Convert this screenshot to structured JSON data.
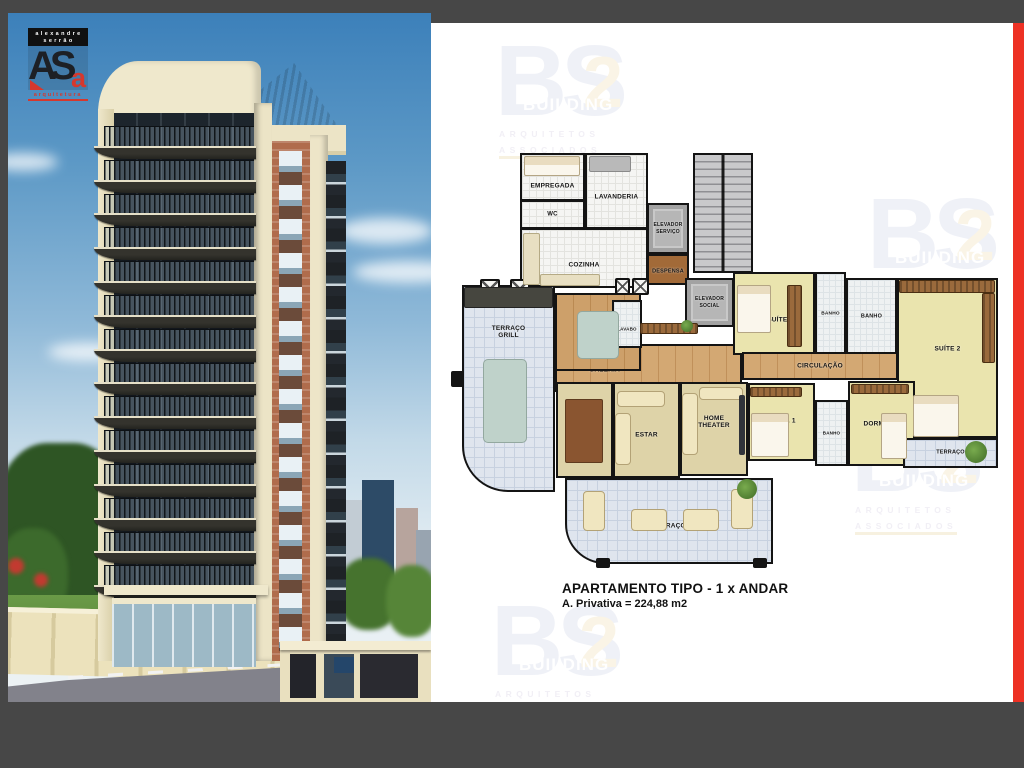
{
  "page": {
    "background": "#474747",
    "accent_red": "#ed3124",
    "panel_bg": "#ffffff"
  },
  "logo": {
    "name_line1": "alexandre",
    "name_line2": "serrão",
    "monogram_main": "AS",
    "monogram_accent": "a",
    "field": "arquitetura"
  },
  "watermark": {
    "letters": "BS",
    "number": "2",
    "word": "BUILDING",
    "sub_line1": "ARQUITETOS",
    "sub_line2": "ASSOCIADOS",
    "positions": [
      {
        "x": 64,
        "y": 10
      },
      {
        "x": 436,
        "y": 163
      },
      {
        "x": 420,
        "y": 386
      },
      {
        "x": 60,
        "y": 570
      }
    ]
  },
  "rendering": {
    "balcony_floors": 14
  },
  "plan": {
    "title": "APARTAMENTO TIPO - 1 x ANDAR",
    "area_note": "A. Privativa = 224,88 m2",
    "rooms": [
      {
        "id": "escada",
        "label": "",
        "x": 262,
        "y": 130,
        "w": 60,
        "h": 120,
        "floor": "stair"
      },
      {
        "id": "cozinha",
        "label": "COZINHA",
        "x": 89,
        "y": 205,
        "w": 128,
        "h": 60,
        "floor": "tile",
        "ty": 62
      },
      {
        "id": "empregada",
        "label": "EMPREGADA",
        "x": 89,
        "y": 130,
        "w": 65,
        "h": 48,
        "floor": "tile",
        "ty": 70
      },
      {
        "id": "wc",
        "label": "WC",
        "x": 89,
        "y": 177,
        "w": 65,
        "h": 29,
        "floor": "tile",
        "fs": 6
      },
      {
        "id": "lavanderia",
        "label": "LAVANDERIA",
        "x": 154,
        "y": 130,
        "w": 63,
        "h": 76,
        "floor": "tile",
        "ty": 58
      },
      {
        "id": "elevador-servico",
        "label": "ELEVADOR\nSERVIÇO",
        "x": 216,
        "y": 180,
        "w": 42,
        "h": 51,
        "floor": "lift",
        "fs": 5
      },
      {
        "id": "despensa",
        "label": "DESPENSA",
        "x": 216,
        "y": 231,
        "w": 42,
        "h": 31,
        "floor": "brown",
        "fs": 5.5,
        "ty": 60
      },
      {
        "id": "elevador-social",
        "label": "ELEVADOR\nSOCIAL",
        "x": 254,
        "y": 255,
        "w": 49,
        "h": 49,
        "floor": "lift",
        "fs": 5
      },
      {
        "id": "terraco-grill",
        "label": "TERRAÇO\nGRILL",
        "x": 31,
        "y": 262,
        "w": 93,
        "h": 207,
        "floor": "terrace",
        "ty": 22,
        "r": "0 0 0 46px"
      },
      {
        "id": "galeria",
        "label": "GALERIA",
        "x": 124,
        "y": 321,
        "w": 187,
        "h": 48,
        "floor": "wood2",
        "tx": 26,
        "ty": 55
      },
      {
        "id": "almoco",
        "label": "ALMOÇO",
        "x": 124,
        "y": 270,
        "w": 86,
        "h": 78,
        "floor": "wood",
        "ty": 58
      },
      {
        "id": "lavabo",
        "label": "LAVABO",
        "x": 181,
        "y": 277,
        "w": 30,
        "h": 48,
        "floor": "bath",
        "fs": 4.5,
        "ty": 62
      },
      {
        "id": "suite1",
        "label": "SUÍTE 1",
        "x": 302,
        "y": 249,
        "w": 82,
        "h": 83,
        "floor": "suite",
        "tx": 58,
        "ty": 58
      },
      {
        "id": "banho-suite1",
        "label": "BANHO",
        "x": 384,
        "y": 249,
        "w": 31,
        "h": 83,
        "floor": "bath",
        "fs": 4.8
      },
      {
        "id": "banho-suite2",
        "label": "BANHO",
        "x": 415,
        "y": 255,
        "w": 51,
        "h": 77,
        "floor": "bath",
        "fs": 5.5
      },
      {
        "id": "suite2",
        "label": "SUÍTE 2",
        "x": 466,
        "y": 255,
        "w": 101,
        "h": 160,
        "floor": "suite",
        "ty": 44
      },
      {
        "id": "circulacao",
        "label": "CIRCULAÇÃO",
        "x": 311,
        "y": 329,
        "w": 156,
        "h": 28,
        "floor": "wood2"
      },
      {
        "id": "jantar",
        "label": "JANTAR",
        "x": 125,
        "y": 359,
        "w": 57,
        "h": 96,
        "floor": "carpet",
        "ty": 46
      },
      {
        "id": "estar",
        "label": "ESTAR",
        "x": 182,
        "y": 359,
        "w": 67,
        "h": 96,
        "floor": "carpet",
        "ty": 55
      },
      {
        "id": "home-theater",
        "label": "HOME\nTHEATER",
        "x": 249,
        "y": 359,
        "w": 68,
        "h": 94,
        "floor": "carpet",
        "ty": 42
      },
      {
        "id": "dorm1",
        "label": "DORM. 1",
        "x": 317,
        "y": 360,
        "w": 67,
        "h": 78,
        "floor": "suite",
        "ty": 48
      },
      {
        "id": "banho-dorms",
        "label": "BANHO",
        "x": 384,
        "y": 377,
        "w": 33,
        "h": 66,
        "floor": "bath",
        "fs": 4.5
      },
      {
        "id": "dorm2",
        "label": "DORM. 2",
        "x": 417,
        "y": 358,
        "w": 67,
        "h": 85,
        "floor": "suite",
        "tx": 44,
        "ty": 50
      },
      {
        "id": "terraco-suite2",
        "label": "TERRAÇO",
        "x": 472,
        "y": 415,
        "w": 95,
        "h": 30,
        "floor": "terrace",
        "fs": 5.5
      },
      {
        "id": "terraco-social",
        "label": "TERRAÇO",
        "x": 134,
        "y": 455,
        "w": 208,
        "h": 86,
        "floor": "terrace",
        "ty": 56,
        "r": "0 0 0 40px"
      }
    ],
    "furniture": [
      {
        "t": "column",
        "x": 49,
        "y": 256,
        "w": 20,
        "h": 20
      },
      {
        "t": "column",
        "x": 79,
        "y": 256,
        "w": 20,
        "h": 20
      },
      {
        "t": "column",
        "x": 184,
        "y": 255,
        "w": 15,
        "h": 17
      },
      {
        "t": "column",
        "x": 201,
        "y": 255,
        "w": 17,
        "h": 17
      },
      {
        "t": "wall-block",
        "x": 165,
        "y": 535,
        "w": 14,
        "h": 10
      },
      {
        "t": "wall-block",
        "x": 322,
        "y": 535,
        "w": 14,
        "h": 10
      },
      {
        "t": "wall-block",
        "x": 20,
        "y": 348,
        "w": 13,
        "h": 16
      },
      {
        "t": "counter-dark",
        "x": 33,
        "y": 264,
        "w": 89,
        "h": 21
      },
      {
        "t": "table-glass",
        "x": 52,
        "y": 336,
        "w": 44,
        "h": 84
      },
      {
        "t": "table-glass",
        "x": 146,
        "y": 288,
        "w": 42,
        "h": 48
      },
      {
        "t": "table-wood",
        "x": 134,
        "y": 376,
        "w": 38,
        "h": 64
      },
      {
        "t": "sofa",
        "x": 186,
        "y": 368,
        "w": 48,
        "h": 16
      },
      {
        "t": "sofa",
        "x": 184,
        "y": 390,
        "w": 16,
        "h": 52
      },
      {
        "t": "sofa",
        "x": 251,
        "y": 370,
        "w": 16,
        "h": 62
      },
      {
        "t": "sofa",
        "x": 268,
        "y": 364,
        "w": 44,
        "h": 13
      },
      {
        "t": "screen",
        "x": 308,
        "y": 372,
        "w": 6,
        "h": 60
      },
      {
        "t": "bed",
        "x": 306,
        "y": 262,
        "w": 34,
        "h": 48
      },
      {
        "t": "closet",
        "x": 356,
        "y": 262,
        "w": 15,
        "h": 62
      },
      {
        "t": "bed",
        "x": 482,
        "y": 372,
        "w": 46,
        "h": 42
      },
      {
        "t": "closet",
        "x": 468,
        "y": 257,
        "w": 96,
        "h": 13
      },
      {
        "t": "closet",
        "x": 551,
        "y": 270,
        "w": 13,
        "h": 70
      },
      {
        "t": "closet",
        "x": 319,
        "y": 364,
        "w": 52,
        "h": 10
      },
      {
        "t": "bed",
        "x": 320,
        "y": 390,
        "w": 38,
        "h": 44
      },
      {
        "t": "closet",
        "x": 420,
        "y": 361,
        "w": 58,
        "h": 10
      },
      {
        "t": "bed",
        "x": 450,
        "y": 390,
        "w": 26,
        "h": 46
      },
      {
        "t": "bed",
        "x": 93,
        "y": 133,
        "w": 56,
        "h": 20
      },
      {
        "t": "counter",
        "x": 158,
        "y": 133,
        "w": 42,
        "h": 16
      },
      {
        "t": "cabinet",
        "x": 92,
        "y": 210,
        "w": 17,
        "h": 52
      },
      {
        "t": "cabinet",
        "x": 109,
        "y": 251,
        "w": 60,
        "h": 12
      },
      {
        "t": "closet",
        "x": 209,
        "y": 300,
        "w": 58,
        "h": 11
      },
      {
        "t": "sofa",
        "x": 152,
        "y": 468,
        "w": 22,
        "h": 40
      },
      {
        "t": "sofa",
        "x": 200,
        "y": 486,
        "w": 36,
        "h": 22
      },
      {
        "t": "sofa",
        "x": 252,
        "y": 486,
        "w": 36,
        "h": 22
      },
      {
        "t": "sofa",
        "x": 300,
        "y": 466,
        "w": 22,
        "h": 40
      },
      {
        "t": "plant",
        "x": 306,
        "y": 456,
        "w": 20,
        "h": 20
      },
      {
        "t": "plant",
        "x": 534,
        "y": 418,
        "w": 22,
        "h": 22
      },
      {
        "t": "plant",
        "x": 250,
        "y": 297,
        "w": 12,
        "h": 12
      }
    ]
  }
}
